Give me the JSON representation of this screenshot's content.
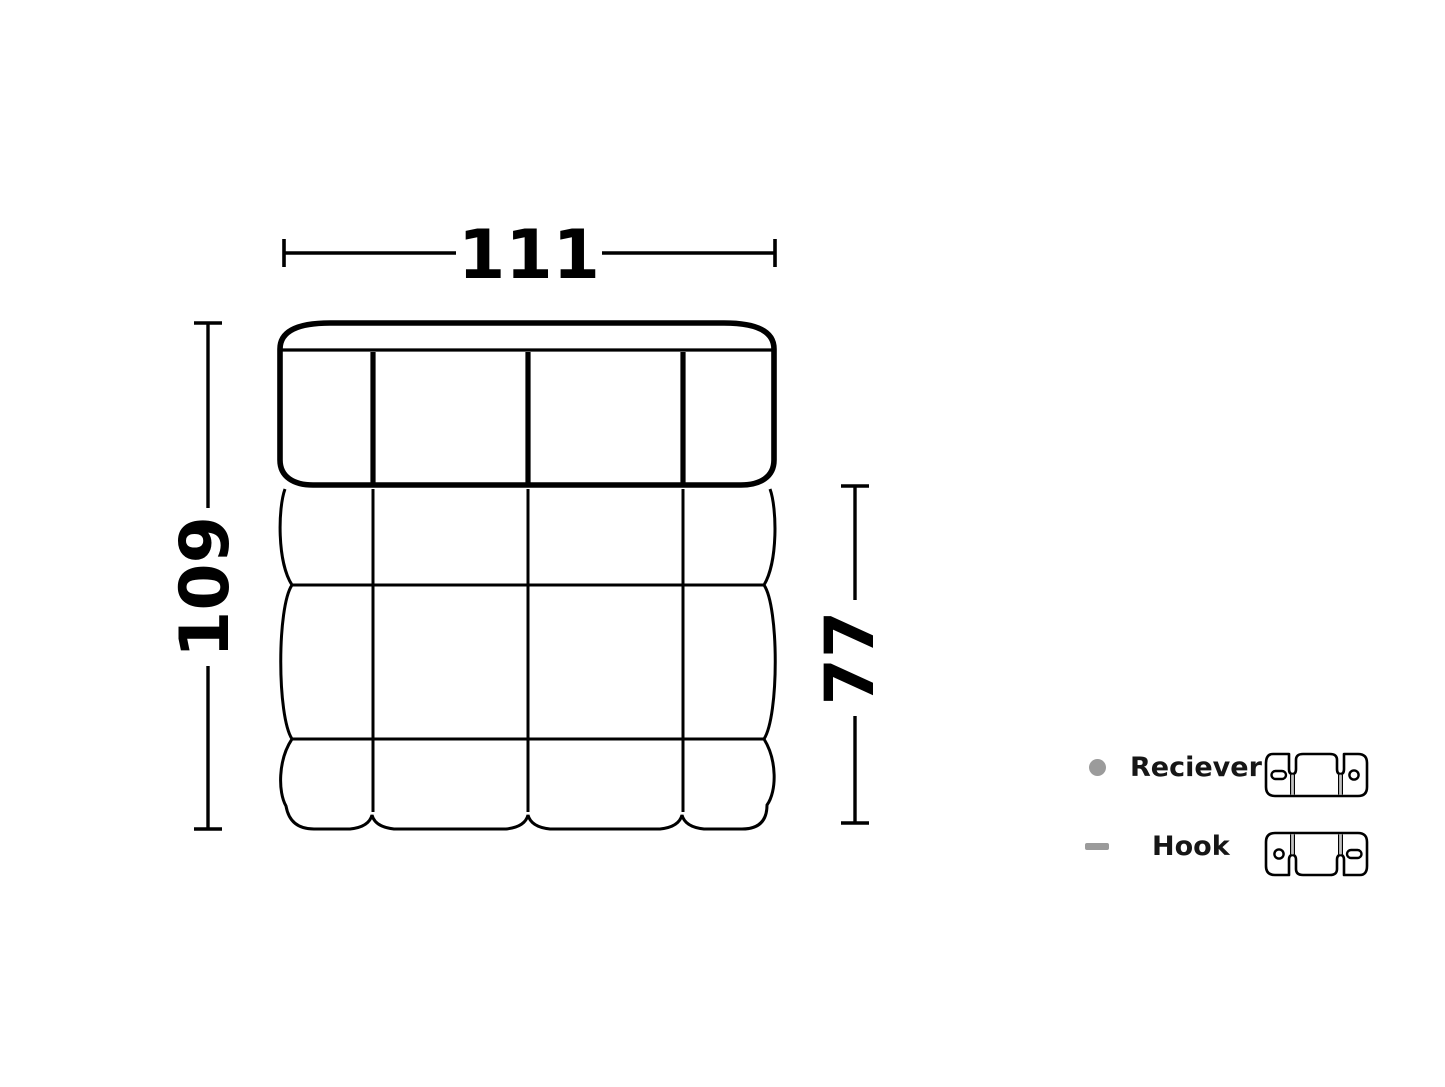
{
  "colors": {
    "line": "#000000",
    "marker": "#9b9b9b",
    "label_text": "#161616",
    "background": "#ffffff"
  },
  "dimensions": {
    "width": {
      "value": "111"
    },
    "height": {
      "value": "109"
    },
    "depth": {
      "value": "77"
    }
  },
  "legend": {
    "items": [
      {
        "label": "Reciever",
        "marker": "dot"
      },
      {
        "label": "Hook",
        "marker": "dash"
      }
    ]
  }
}
